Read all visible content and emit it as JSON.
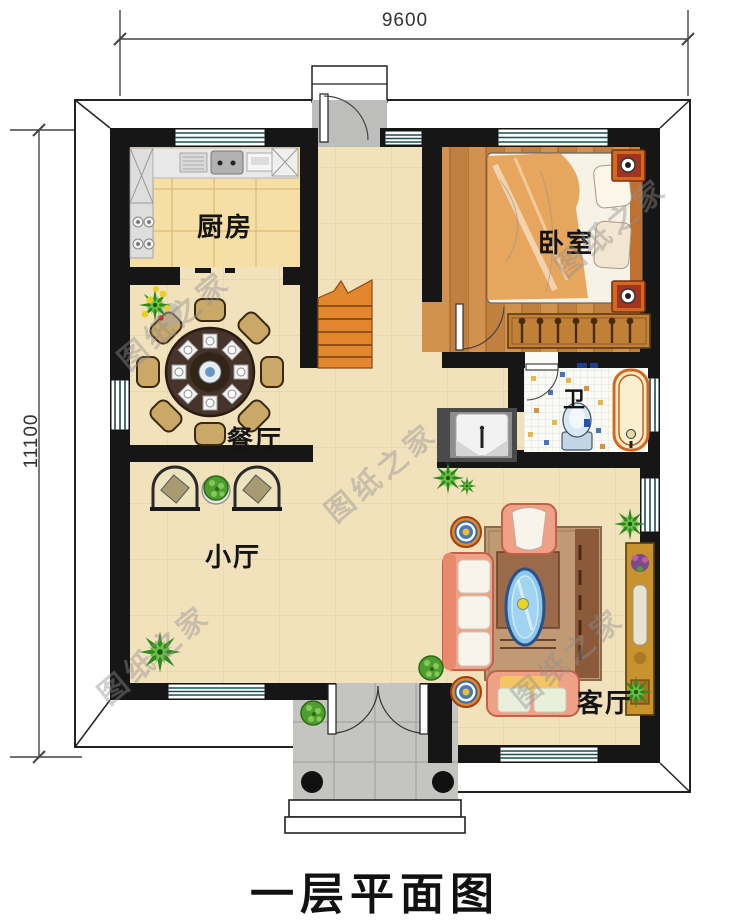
{
  "title": {
    "text": "一层平面图"
  },
  "dimensions": {
    "width": "9600",
    "height": "11100"
  },
  "rooms": {
    "kitchen": "厨房",
    "bedroom": "卧室",
    "dining": "餐厅",
    "bath": "卫",
    "hall": "小厅",
    "living": "客厅"
  },
  "watermark": {
    "text": "图纸之家"
  },
  "colors": {
    "wall": "#161616",
    "floor_main": "#F2E2BC",
    "floor_kitchen": "#F6DFA4",
    "floor_wood": "#CE8F4D",
    "stairs": "#E2872E",
    "porch": "#C4C4C0",
    "sofa": "#EFA188",
    "window_frame": "#1E4C55",
    "tub_rim": "#D2691E",
    "table_wood": "#46342A",
    "coffee_table_glass": "#8CC8EC"
  }
}
